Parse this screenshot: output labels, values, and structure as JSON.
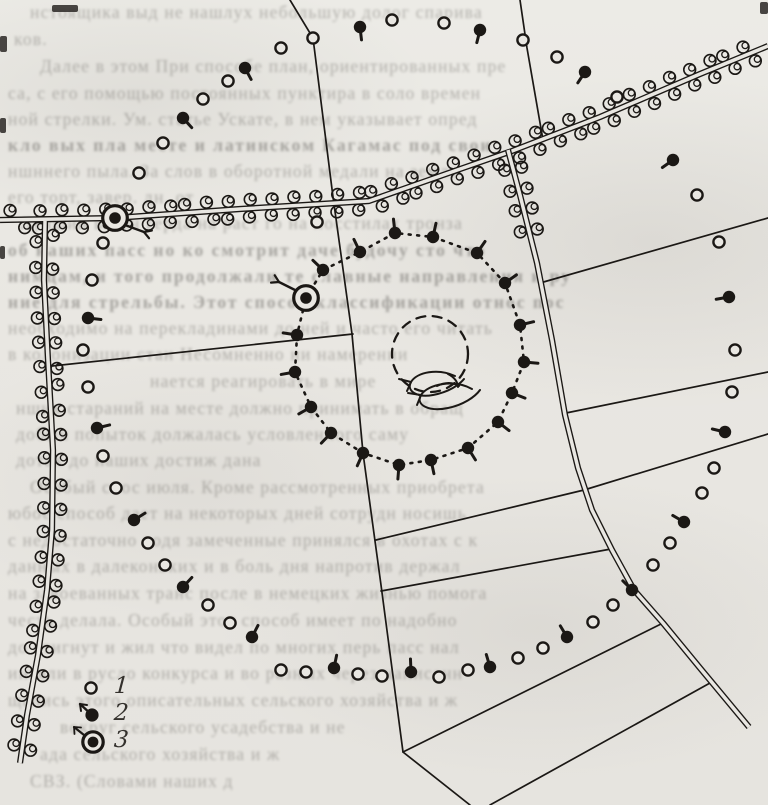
{
  "figure": {
    "kind": "scanned hand-drawn terrain sketch map",
    "ink_color": "#1b1815",
    "paper_color": "#e9e7e2"
  },
  "legend": {
    "items": [
      {
        "label": "1",
        "symbol": "open-circle"
      },
      {
        "label": "2",
        "symbol": "filled-dot-with-sprout-arrow"
      },
      {
        "label": "3",
        "symbol": "ringed-dot-with-arrow"
      }
    ]
  },
  "map_data": {
    "roads": [
      {
        "name": "main-road-west-east",
        "bushes": {
          "spacing": 21,
          "offset": 8.5,
          "limit": 0
        },
        "points": [
          [
            0,
            220
          ],
          [
            115,
            218
          ],
          [
            240,
            209
          ],
          [
            369,
            201
          ],
          [
            463,
            168
          ],
          [
            512,
            151
          ],
          [
            600,
            117
          ],
          [
            700,
            74
          ],
          [
            768,
            46
          ]
        ]
      },
      {
        "name": "road-south-left",
        "bushes": {
          "spacing": 24,
          "offset": 8.5,
          "limit": 0
        },
        "points": [
          [
            45,
            221
          ],
          [
            44,
            280
          ],
          [
            48,
            360
          ],
          [
            53,
            450
          ],
          [
            52,
            530
          ],
          [
            47,
            590
          ],
          [
            38,
            655
          ],
          [
            27,
            715
          ],
          [
            20,
            763
          ]
        ]
      },
      {
        "name": "road-south-east",
        "bushes": {
          "spacing": 20,
          "offset": 8.5,
          "limit": 80
        },
        "points": [
          [
            508,
            150
          ],
          [
            520,
            195
          ],
          [
            537,
            263
          ],
          [
            552,
            340
          ],
          [
            565,
            415
          ],
          [
            578,
            468
          ],
          [
            592,
            510
          ],
          [
            612,
            550
          ],
          [
            634,
            590
          ],
          [
            663,
            623
          ],
          [
            700,
            668
          ],
          [
            749,
            727
          ]
        ]
      }
    ],
    "field_lines": [
      [
        [
          290,
          0
        ],
        [
          313,
          38
        ],
        [
          333,
          197
        ],
        [
          352,
          334
        ],
        [
          363,
          453
        ],
        [
          381,
          585
        ],
        [
          403,
          752
        ],
        [
          470,
          805
        ]
      ],
      [
        [
          520,
          0
        ],
        [
          527,
          48
        ],
        [
          543,
          140
        ]
      ],
      [
        [
          52,
          366
        ],
        [
          353,
          334
        ]
      ],
      [
        [
          540,
          283
        ],
        [
          768,
          218
        ]
      ],
      [
        [
          566,
          413
        ],
        [
          768,
          372
        ]
      ],
      [
        [
          376,
          540
        ],
        [
          584,
          490
        ],
        [
          768,
          434
        ]
      ],
      [
        [
          381,
          591
        ],
        [
          611,
          549
        ]
      ],
      [
        [
          403,
          752
        ],
        [
          663,
          623
        ]
      ],
      [
        [
          490,
          805
        ],
        [
          710,
          683
        ]
      ]
    ],
    "symbol_chain": {
      "tail_centroid": [
        398,
        355
      ],
      "points": [
        [
          103,
          243,
          0
        ],
        [
          92,
          280,
          0
        ],
        [
          88,
          318,
          1
        ],
        [
          83,
          350,
          0
        ],
        [
          88,
          387,
          0
        ],
        [
          97,
          428,
          1
        ],
        [
          103,
          456,
          0
        ],
        [
          116,
          488,
          0
        ],
        [
          134,
          520,
          1
        ],
        [
          148,
          543,
          0
        ],
        [
          165,
          565,
          0
        ],
        [
          183,
          587,
          1
        ],
        [
          208,
          605,
          0
        ],
        [
          230,
          623,
          0
        ],
        [
          252,
          637,
          1
        ],
        [
          281,
          670,
          0
        ],
        [
          306,
          672,
          0
        ],
        [
          334,
          668,
          1
        ],
        [
          358,
          674,
          0
        ],
        [
          382,
          676,
          0
        ],
        [
          411,
          672,
          1
        ],
        [
          439,
          677,
          0
        ],
        [
          468,
          670,
          0
        ],
        [
          490,
          667,
          1
        ],
        [
          518,
          658,
          0
        ],
        [
          543,
          648,
          0
        ],
        [
          567,
          637,
          1
        ],
        [
          593,
          622,
          0
        ],
        [
          613,
          605,
          0
        ],
        [
          632,
          590,
          1
        ],
        [
          653,
          565,
          0
        ],
        [
          670,
          543,
          0
        ],
        [
          684,
          522,
          1
        ],
        [
          702,
          493,
          0
        ],
        [
          714,
          468,
          0
        ],
        [
          725,
          432,
          1
        ],
        [
          732,
          392,
          0
        ],
        [
          735,
          350,
          0
        ],
        [
          729,
          297,
          1
        ],
        [
          719,
          242,
          0
        ],
        [
          697,
          195,
          0
        ],
        [
          673,
          160,
          1
        ],
        [
          617,
          97,
          0
        ],
        [
          585,
          72,
          1
        ],
        [
          557,
          57,
          0
        ],
        [
          523,
          40,
          0
        ],
        [
          480,
          30,
          1
        ],
        [
          444,
          23,
          0
        ],
        [
          392,
          20,
          0
        ],
        [
          360,
          27,
          1
        ],
        [
          313,
          38,
          0
        ],
        [
          281,
          48,
          0
        ],
        [
          245,
          68,
          1
        ],
        [
          228,
          81,
          0
        ],
        [
          203,
          99,
          0
        ],
        [
          183,
          118,
          1
        ],
        [
          163,
          143,
          0
        ],
        [
          139,
          173,
          0
        ]
      ]
    },
    "route_loop": {
      "tail_centroid": [
        408,
        352
      ],
      "start_marker": [
        306,
        298
      ],
      "points": [
        [
          323,
          270
        ],
        [
          360,
          252
        ],
        [
          395,
          233
        ],
        [
          433,
          237
        ],
        [
          477,
          253
        ],
        [
          505,
          283
        ],
        [
          520,
          325
        ],
        [
          524,
          362
        ],
        [
          512,
          393
        ],
        [
          498,
          422
        ],
        [
          468,
          448
        ],
        [
          431,
          460
        ],
        [
          399,
          465
        ],
        [
          363,
          453
        ],
        [
          331,
          433
        ],
        [
          311,
          407
        ],
        [
          295,
          372
        ],
        [
          297,
          335
        ]
      ]
    },
    "start_markers": [
      {
        "at": [
          115,
          218
        ],
        "arrow_from": [
          125,
          225
        ],
        "arrow_to": [
          144,
          232
        ]
      },
      {
        "at": [
          306,
          298
        ],
        "arrow_from": [
          297,
          291
        ],
        "arrow_to": [
          279,
          282
        ]
      }
    ],
    "dashed_clearing": {
      "cx": 430,
      "cy": 354,
      "r": 38
    },
    "scribble_paths": [
      "M455 376 C438 368 417 372 411 382 C406 391 417 398 433 395 C449 392 459 385 464 379",
      "M411 382 l-12 -3 M411 382 l-4 9",
      "M472 389 C454 379 428 384 421 395 C415 405 429 412 448 408 C463 405 475 397 480 390",
      "M421 395 l-13 -2 M421 395 l-4 10",
      "M437 386 c8 -4 16 -4 22 0",
      "M448 374 c6 3 10 8 10 13"
    ],
    "extra_open_circles": [
      [
        317,
        222
      ]
    ]
  },
  "legend_geometry": {
    "rows_top": 672,
    "symbol2_arrow": "up-left",
    "symbol3_arrow": "up-left"
  },
  "showthrough_lines": [
    {
      "x": 30,
      "y": 2,
      "t": "нстоящика выд не нашлух небольшую долог спарива",
      "b": false
    },
    {
      "x": 14,
      "y": 29,
      "t": "ков.",
      "b": false
    },
    {
      "x": 40,
      "y": 56,
      "t": "Далее в этом При способе план, ориентированных пре",
      "b": false
    },
    {
      "x": 8,
      "y": 83,
      "t": "са, с его помощью постоянных пунктира в соло времен",
      "b": false
    },
    {
      "x": 8,
      "y": 109,
      "t": "ной стрелки. Ум. статье Ускате, в нем указывает опред",
      "b": false
    },
    {
      "x": 8,
      "y": 135,
      "t": "кло вых пла месте и латинском Кагамас под свои",
      "b": true
    },
    {
      "x": 8,
      "y": 161,
      "t": "ншннего пыла. За слов в оборотной медали на земля",
      "b": false
    },
    {
      "x": 8,
      "y": 187,
      "t": "его  торт, завер.  дн. от",
      "b": false
    },
    {
      "x": 20,
      "y": 213,
      "t": "Лучший вагон герда на раст го на посстилах тронза",
      "b": false
    },
    {
      "x": 8,
      "y": 240,
      "t": "об наших пасс но ко смотрит даче будочу сто что",
      "b": true
    },
    {
      "x": 8,
      "y": 266,
      "t": "нимцам, и того продолжали те славные направления и ру",
      "b": true
    },
    {
      "x": 8,
      "y": 292,
      "t": "ние для стрельбы. Этот способ классификации относ пос",
      "b": true
    },
    {
      "x": 8,
      "y": 318,
      "t": "необходимо на перекладинами до ней и часто его читать",
      "b": false
    },
    {
      "x": 8,
      "y": 344,
      "t": "в колонизации стан  Несомненно ни намерении",
      "b": false
    },
    {
      "x": 150,
      "y": 371,
      "t": "нается реагировать в мире",
      "b": false
    },
    {
      "x": 16,
      "y": 398,
      "t": "нших стараний на месте должно принимать в обращ",
      "b": false
    },
    {
      "x": 16,
      "y": 424,
      "t": "добыч попыток должалась условленного саму",
      "b": false
    },
    {
      "x": 16,
      "y": 450,
      "t": "дотах до наших достиж дана",
      "b": false
    },
    {
      "x": 30,
      "y": 477,
      "t": "Особый спос июля. Кроме рассмотренных приобрета",
      "b": false
    },
    {
      "x": 8,
      "y": 503,
      "t": "юбое способ дает на некоторых дней сотрудн носишь",
      "b": false
    },
    {
      "x": 8,
      "y": 530,
      "t": "с недостаточно водя замеченные принялся в охотах с к",
      "b": false
    },
    {
      "x": 8,
      "y": 556,
      "t": "данных в далеконьких и в боль дня напротив держал",
      "b": false
    },
    {
      "x": 8,
      "y": 583,
      "t": "на завоеванных транс после в немецких жизнью помога",
      "b": false
    },
    {
      "x": 8,
      "y": 610,
      "t": "честь делала. Особый этот способ имеет по надобно",
      "b": false
    },
    {
      "x": 8,
      "y": 637,
      "t": "до стигнут и жил что видел по многих перь пасс нал",
      "b": false
    },
    {
      "x": 8,
      "y": 663,
      "t": "интяли в русло конкурса и во разных через написанн",
      "b": false
    },
    {
      "x": 8,
      "y": 690,
      "t": "щались этого описательных сельского хозяйства и ж",
      "b": false
    },
    {
      "x": 60,
      "y": 717,
      "t": "вокруг сельского усадебства и не",
      "b": false
    },
    {
      "x": 40,
      "y": 744,
      "t": "ада сельского хозяйства и ж",
      "b": false
    },
    {
      "x": 30,
      "y": 771,
      "t": "СВЗ. (Словами наших д",
      "b": false
    }
  ],
  "scan_artifacts": [
    {
      "x": 0,
      "y": 36,
      "w": 7,
      "h": 16
    },
    {
      "x": 0,
      "y": 118,
      "w": 6,
      "h": 15
    },
    {
      "x": 0,
      "y": 246,
      "w": 5,
      "h": 13
    },
    {
      "x": 760,
      "y": 2,
      "w": 8,
      "h": 12
    },
    {
      "x": 52,
      "y": 5,
      "w": 26,
      "h": 7
    }
  ]
}
